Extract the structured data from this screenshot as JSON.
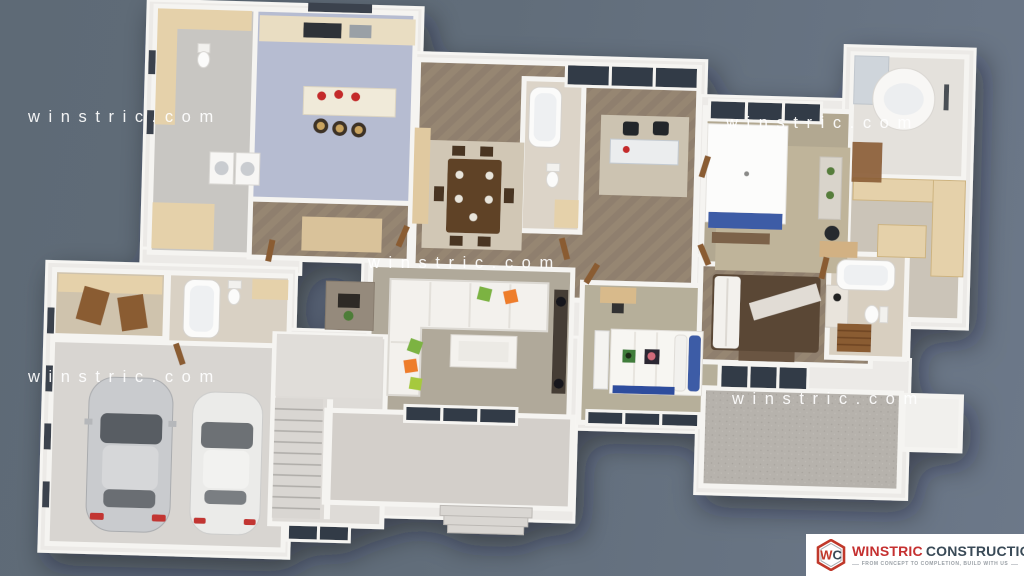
{
  "scene": {
    "background_top": "#5E6A76",
    "background_bottom": "#6C7889",
    "palette": {
      "wall": "#F1F0ED",
      "wood_floor": "#8F7F6E",
      "kitchen_tile": "#B6BCD1",
      "carpet": "#B2A891",
      "cabinet_tan": "#E5D1AA",
      "sofa_white": "#F3F1ED",
      "pillow_green": "#7CB342",
      "pillow_orange": "#EE7D2C",
      "bed_blue": "#3E5CA6",
      "bed_brown": "#5A4735",
      "car_silver": "#C9CBCE",
      "car_white": "#EBEBE9",
      "accent_red": "#C4292B"
    }
  },
  "watermark": {
    "text": "w i n s t r i c . c o m"
  },
  "logo": {
    "monogram_w": "W",
    "monogram_c": "C",
    "brand_primary": "WINSTRIC",
    "brand_secondary": "CONSTRUCTION",
    "tagline": "FROM CONCEPT TO COMPLETION, BUILD WITH US"
  }
}
